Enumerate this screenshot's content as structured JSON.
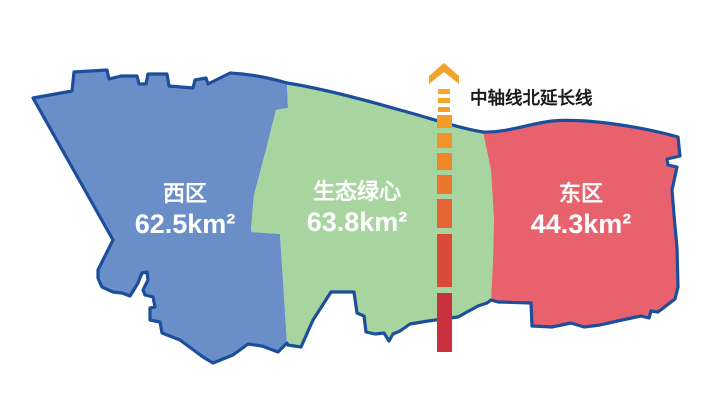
{
  "canvas": {
    "width": 718,
    "height": 407,
    "background": "#ffffff"
  },
  "map": {
    "outline_color": "#1D4E9B",
    "regions": [
      {
        "id": "west",
        "name": "西区",
        "area": "62.5km²",
        "fill": "#6A8EC8",
        "text_color": "#ffffff"
      },
      {
        "id": "green-heart",
        "name": "生态绿心",
        "area": "63.8km²",
        "fill": "#A8D4A0",
        "text_color": "#ffffff"
      },
      {
        "id": "east",
        "name": "东区",
        "area": "44.3km²",
        "fill": "#E7626C",
        "text_color": "#ffffff"
      }
    ]
  },
  "axis": {
    "label": "中轴线北延长线",
    "label_color": "#1B1B1B",
    "arrow_color": "#F1A32B",
    "segment_colors": [
      "#F6A52B",
      "#F5A02B",
      "#F49C2A",
      "#F2922A",
      "#EF862C",
      "#EA772F",
      "#E46434",
      "#DA4A38",
      "#C8303E"
    ],
    "top_dash_color": "#F6A82C"
  }
}
